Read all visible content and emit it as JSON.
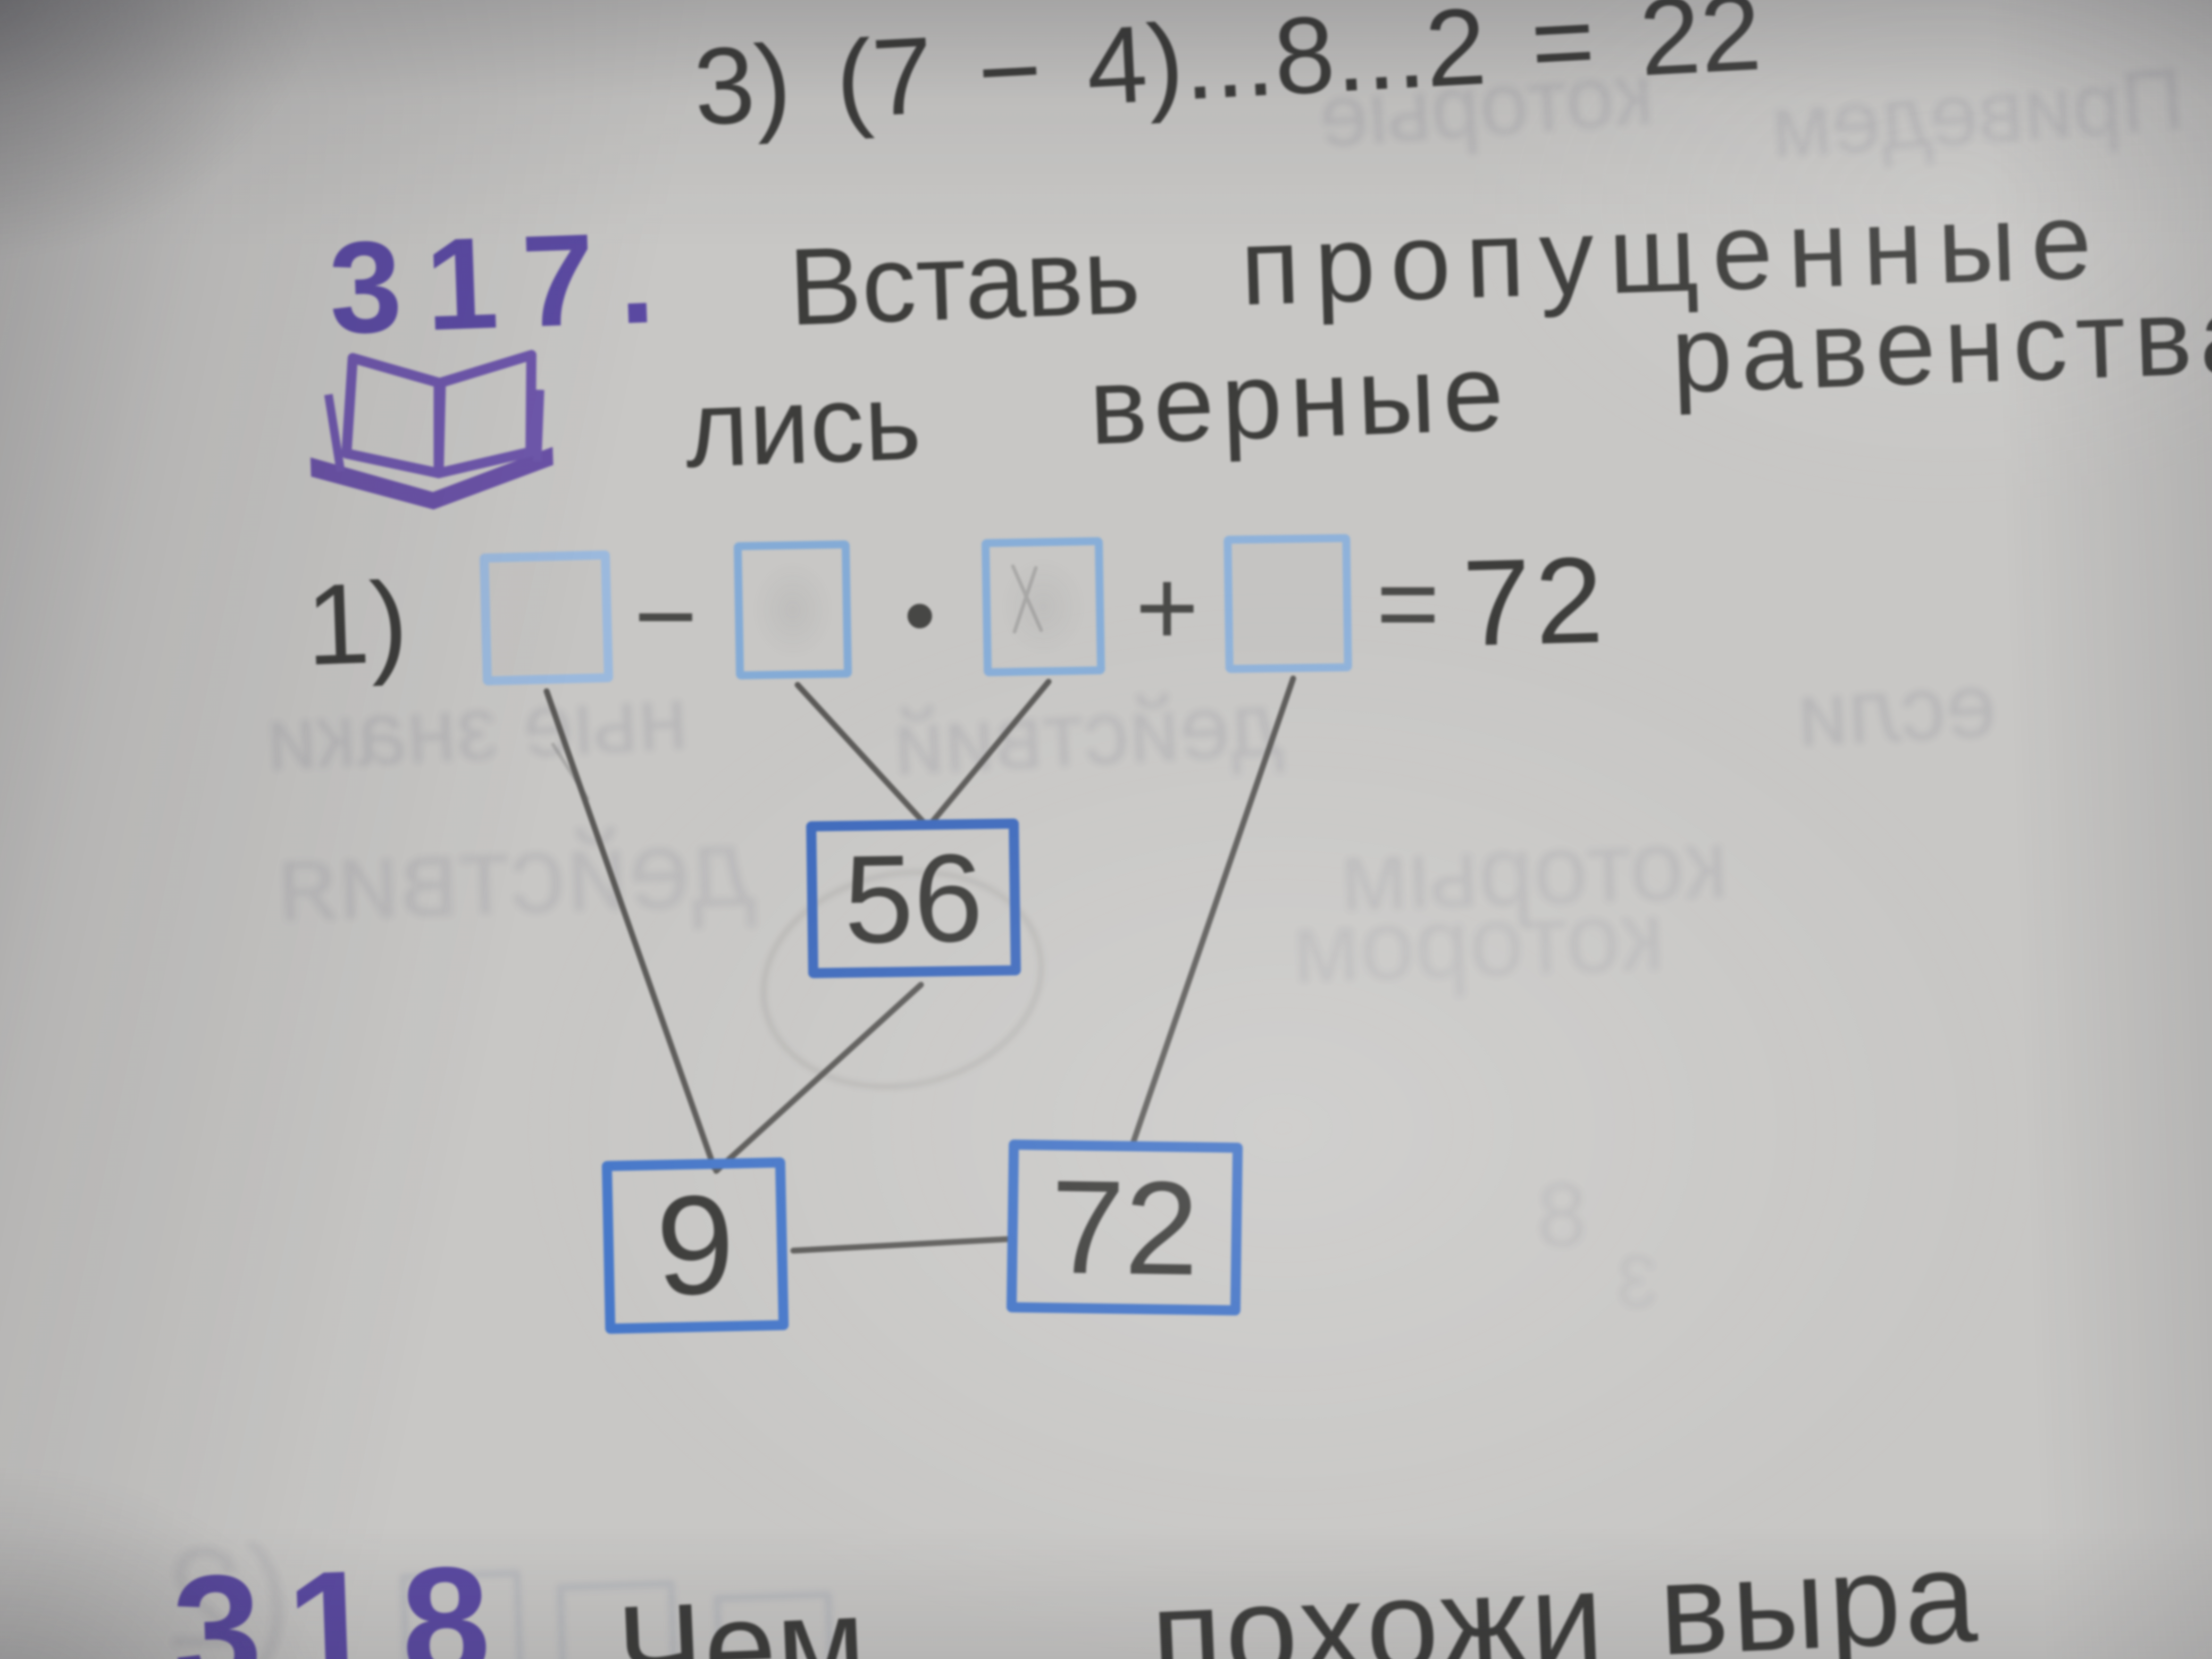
{
  "photo": {
    "top_line": "3) (7 − 4)...8...2 = 22",
    "task317": {
      "number": "317.",
      "line1_word1": "Вставь",
      "line1_word2": "пропущенные",
      "line2_word1": "лись",
      "line2_word2": "верные",
      "line2_word3": "равенства"
    },
    "equation": {
      "label": "1)",
      "minus": "−",
      "dot": "•",
      "plus": "+",
      "equals": "=",
      "result": "72"
    },
    "diagram": {
      "top": "56",
      "bottom_left": "9",
      "bottom_right": "72"
    },
    "task318": {
      "number": "318",
      "word1": "Чем",
      "word2": "похожи",
      "word3": "выра"
    },
    "ghost": {
      "w0": "которые",
      "w1": "Приведем",
      "w2": "ные знаки",
      "w3": "действий",
      "w4": "если",
      "w5": "действия",
      "w6": "которым",
      "w7": "котором",
      "d0": "8",
      "d1": "3",
      "p0": "(2"
    },
    "colors": {
      "accent_purple": "#5b4aa2",
      "ink": "#3d3d3b",
      "answer_box_blue": "#8fb3da",
      "node_box_blue": "#4372c4",
      "connector_gray": "#4f4e4c",
      "paper": "#c8c7c5"
    }
  }
}
